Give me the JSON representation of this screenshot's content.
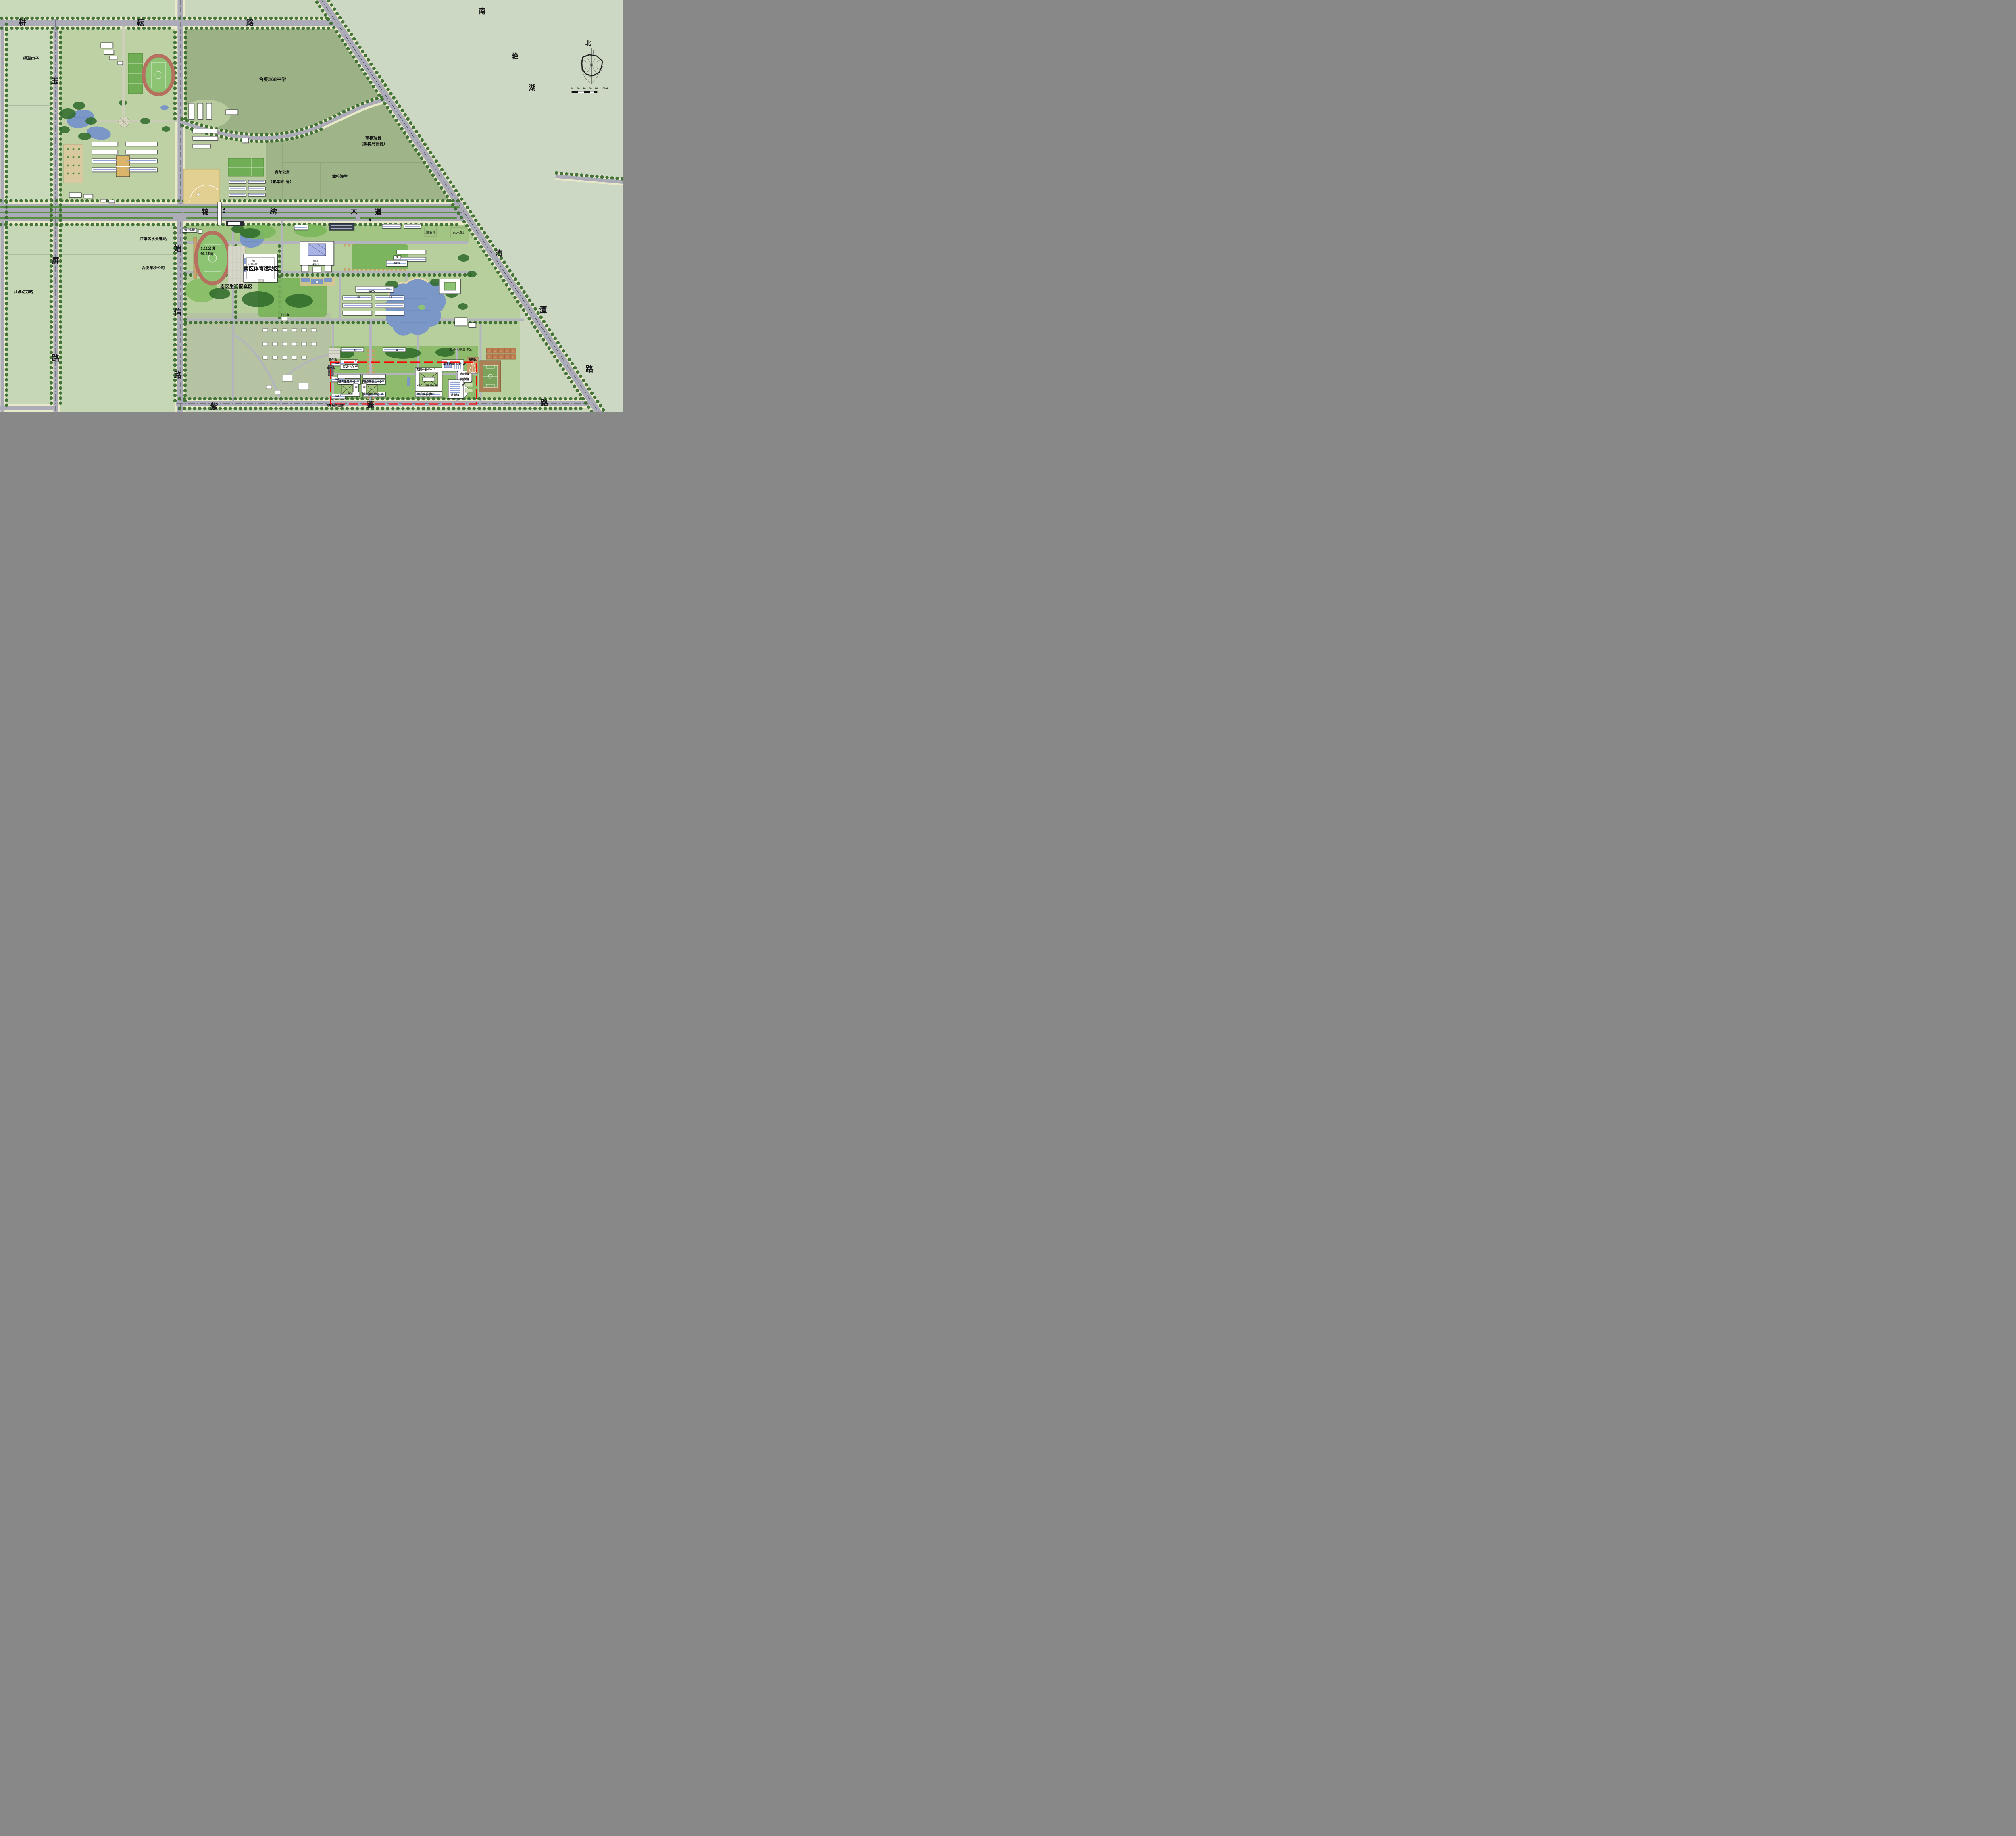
{
  "compass": {
    "north": "北"
  },
  "scale_bar": {
    "ticks": [
      "0",
      "20",
      "40",
      "60",
      "80"
    ],
    "end_label": "100M"
  },
  "roads": {
    "gengyun": {
      "name": "耕耘路",
      "chars": [
        "耕",
        "耘",
        "路"
      ]
    },
    "yuping": {
      "name": "玉屏路",
      "chars": [
        "玉",
        "屏",
        "路"
      ]
    },
    "jinxiu": {
      "name": "锦绣大道",
      "chars": [
        "锦",
        "绣",
        "大",
        "道"
      ]
    },
    "shixin": {
      "name": "始信路",
      "chars": [
        "始",
        "信",
        "路"
      ]
    },
    "qingtan": {
      "name": "清潭路",
      "chars": [
        "清",
        "潭",
        "路"
      ]
    },
    "zipeng": {
      "name": "紫蓬路",
      "chars": [
        "紫",
        "蓬",
        "路"
      ]
    }
  },
  "places": {
    "nanyan_lake": {
      "chars": [
        "南",
        "艳",
        "湖"
      ]
    },
    "derun_electronics": "得润电子",
    "hefei_168_school": "合肥168中学",
    "nanyan_ruijing": "南艳瑞景",
    "nanyan_ruijing_sub": "（国税局宿舍）",
    "youth_apartment": "青年公寓",
    "youth_apartment_sub": "（青年城1号）",
    "jinyu_coast": "金屿海岸",
    "jianghuai_sewage_station": "江淮污水处理站",
    "hefei_cheqiao_company": "合肥车桥公司",
    "jianghuai_power_station": "江淮动力站",
    "gas_station": "加油站",
    "sewage_pump_plant": "污水泵厂",
    "south_sports_zone": "南区体育运动区",
    "south_living_zone": "南区生活配套区",
    "outdoor_activity_zone": "室外天然活动区",
    "throwing_area": "投掷区",
    "track_area_hectare": "3.11公顷",
    "track_area_mu": "46.65亩",
    "de_center_building": "德中心楼",
    "gate_house": "门卫房",
    "parking_lot": "停车场",
    "power_room": "配电房",
    "youth_teacher_housing": "青年教师过渡房"
  },
  "buildings": {
    "training_center_west": "实训中心",
    "graduate_education": "研究生教育楼",
    "innovation_center": "学生创新创业中心",
    "student_service_center": "学生服务中心",
    "student_activity_center": "学生活动中心",
    "fencing_hall": "击剑馆",
    "martial_arts_hall": "武术馆",
    "swimming_hall": "游泳馆",
    "training_center_east": "实训中心",
    "comprehensive_lab": "综合实验楼"
  },
  "tags": {
    "f1": "1F",
    "f2": "2F",
    "f3": "3F",
    "f4": "4F",
    "f6": "6F",
    "f11": "11F",
    "h15": "H=15m",
    "gym_no": "7931",
    "gym_area": "13183.88",
    "lib_no": "9021",
    "lib_area": "41479",
    "dorm_len": "22000",
    "slab_len": "28900"
  },
  "colors": {
    "field_light": "#cbd7bd",
    "field_dark": "#9cb286",
    "road": "#abacb8",
    "water": "#7b97c7",
    "track": "#b5705f",
    "lawn": "#83bd62",
    "canopy": "#2f6b2a",
    "boundary_red": "#ff0000",
    "court_orange": "#bc7b4e"
  }
}
